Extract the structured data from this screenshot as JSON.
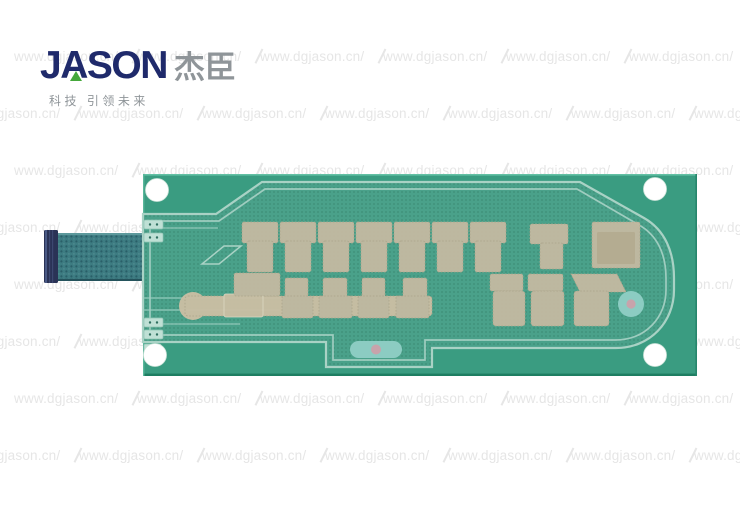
{
  "logo": {
    "brand_en": "JASON",
    "brand_cn": "杰臣",
    "tagline": "科技 引领未来"
  },
  "watermark": {
    "text": "www.dgjason.cn/",
    "rows": 8,
    "cols": 7,
    "start_y": 48,
    "row_height": 57,
    "col_width": 123,
    "even_row_x": 14,
    "odd_row_x": -44
  },
  "palette": {
    "board_green": "#3a9c81",
    "board_edge_light": "#63c0a4",
    "board_edge_dark": "#1e7e62",
    "texture_green": "#4aa18a",
    "texture_dot": "#3d8f77",
    "trace_outline": "#a9d2c5",
    "pad_beige": "#c2b9a1",
    "pad_beige_light": "#cdc5ad",
    "pad_edge": "#b0a58b",
    "strip_beige": "#cabfa4",
    "tail_teal": "#3d7c82",
    "tail_dot": "#2a5f68",
    "connector_navy": "#2a3356",
    "window_teal": "#8cccc2",
    "dot_pink": "#c8a3ab",
    "hole_white": "#ffffff",
    "logo_navy": "#1f2a6b",
    "logo_green": "#45a83b",
    "logo_gray": "#8f9599",
    "watermark_gray": "#e6e6e6"
  }
}
